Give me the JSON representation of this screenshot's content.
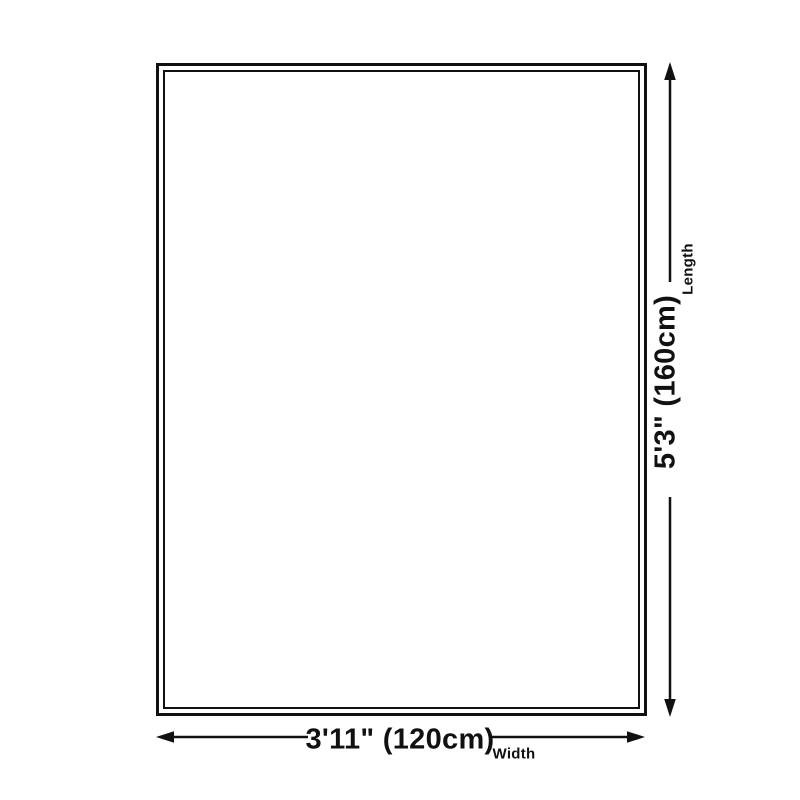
{
  "diagram": {
    "length": {
      "value": "5'3\" (160cm)",
      "label": "Length"
    },
    "width": {
      "value": "3'11\" (120cm)",
      "label": "Width"
    }
  },
  "icons": {
    "vertical_arrow": "double-headed-arrow-vertical",
    "horizontal_arrow": "double-headed-arrow-horizontal"
  },
  "colors": {
    "ink": "#111111",
    "background": "#ffffff"
  }
}
